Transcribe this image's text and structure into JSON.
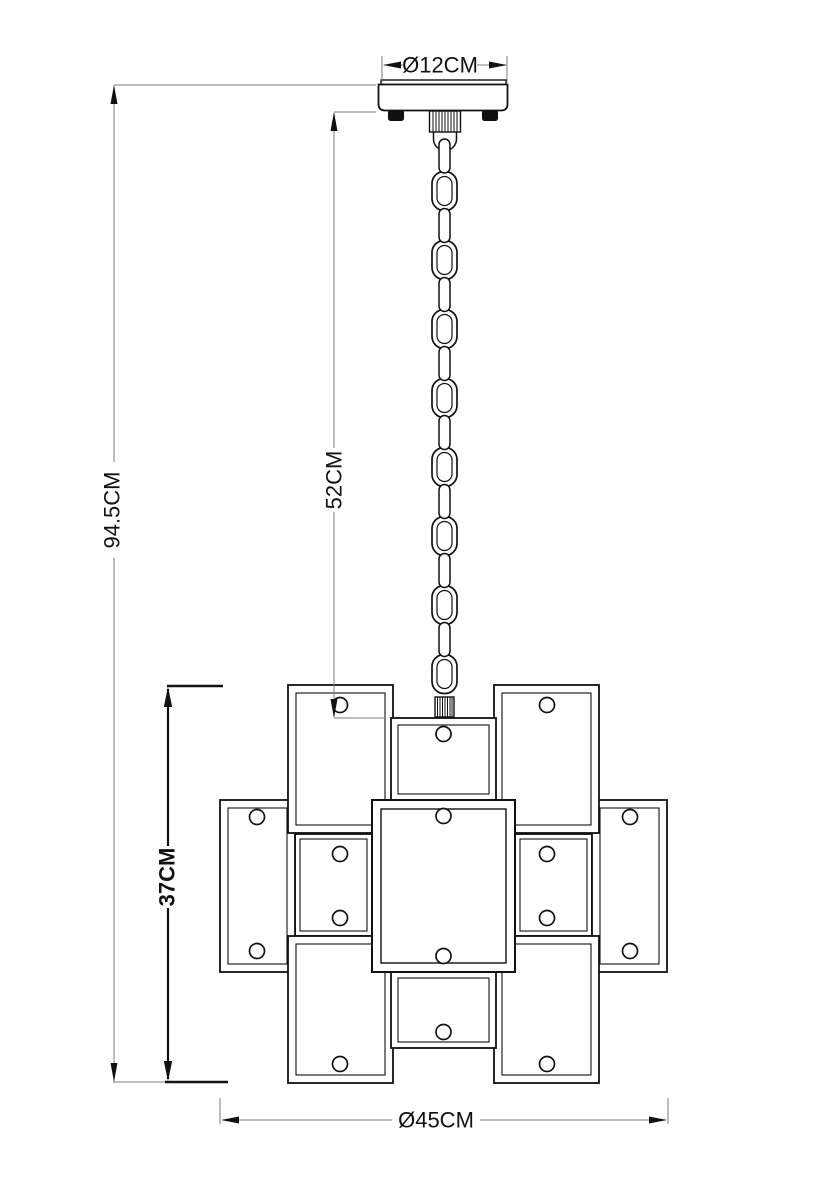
{
  "diagram": {
    "unit": "CM",
    "dimensions": {
      "canopy_diameter": {
        "label": "Ø12CM",
        "value_cm": 12
      },
      "chain_length": {
        "label": "52CM",
        "value_cm": 52
      },
      "total_height": {
        "label": "94.5CM",
        "value_cm": 94.5
      },
      "body_height": {
        "label": "37CM",
        "value_cm": 37
      },
      "body_diameter": {
        "label": "Ø45CM",
        "value_cm": 45
      }
    },
    "colors": {
      "outline": "#111111",
      "dimension_line": "#7b7b7b",
      "background": "#ffffff"
    }
  }
}
